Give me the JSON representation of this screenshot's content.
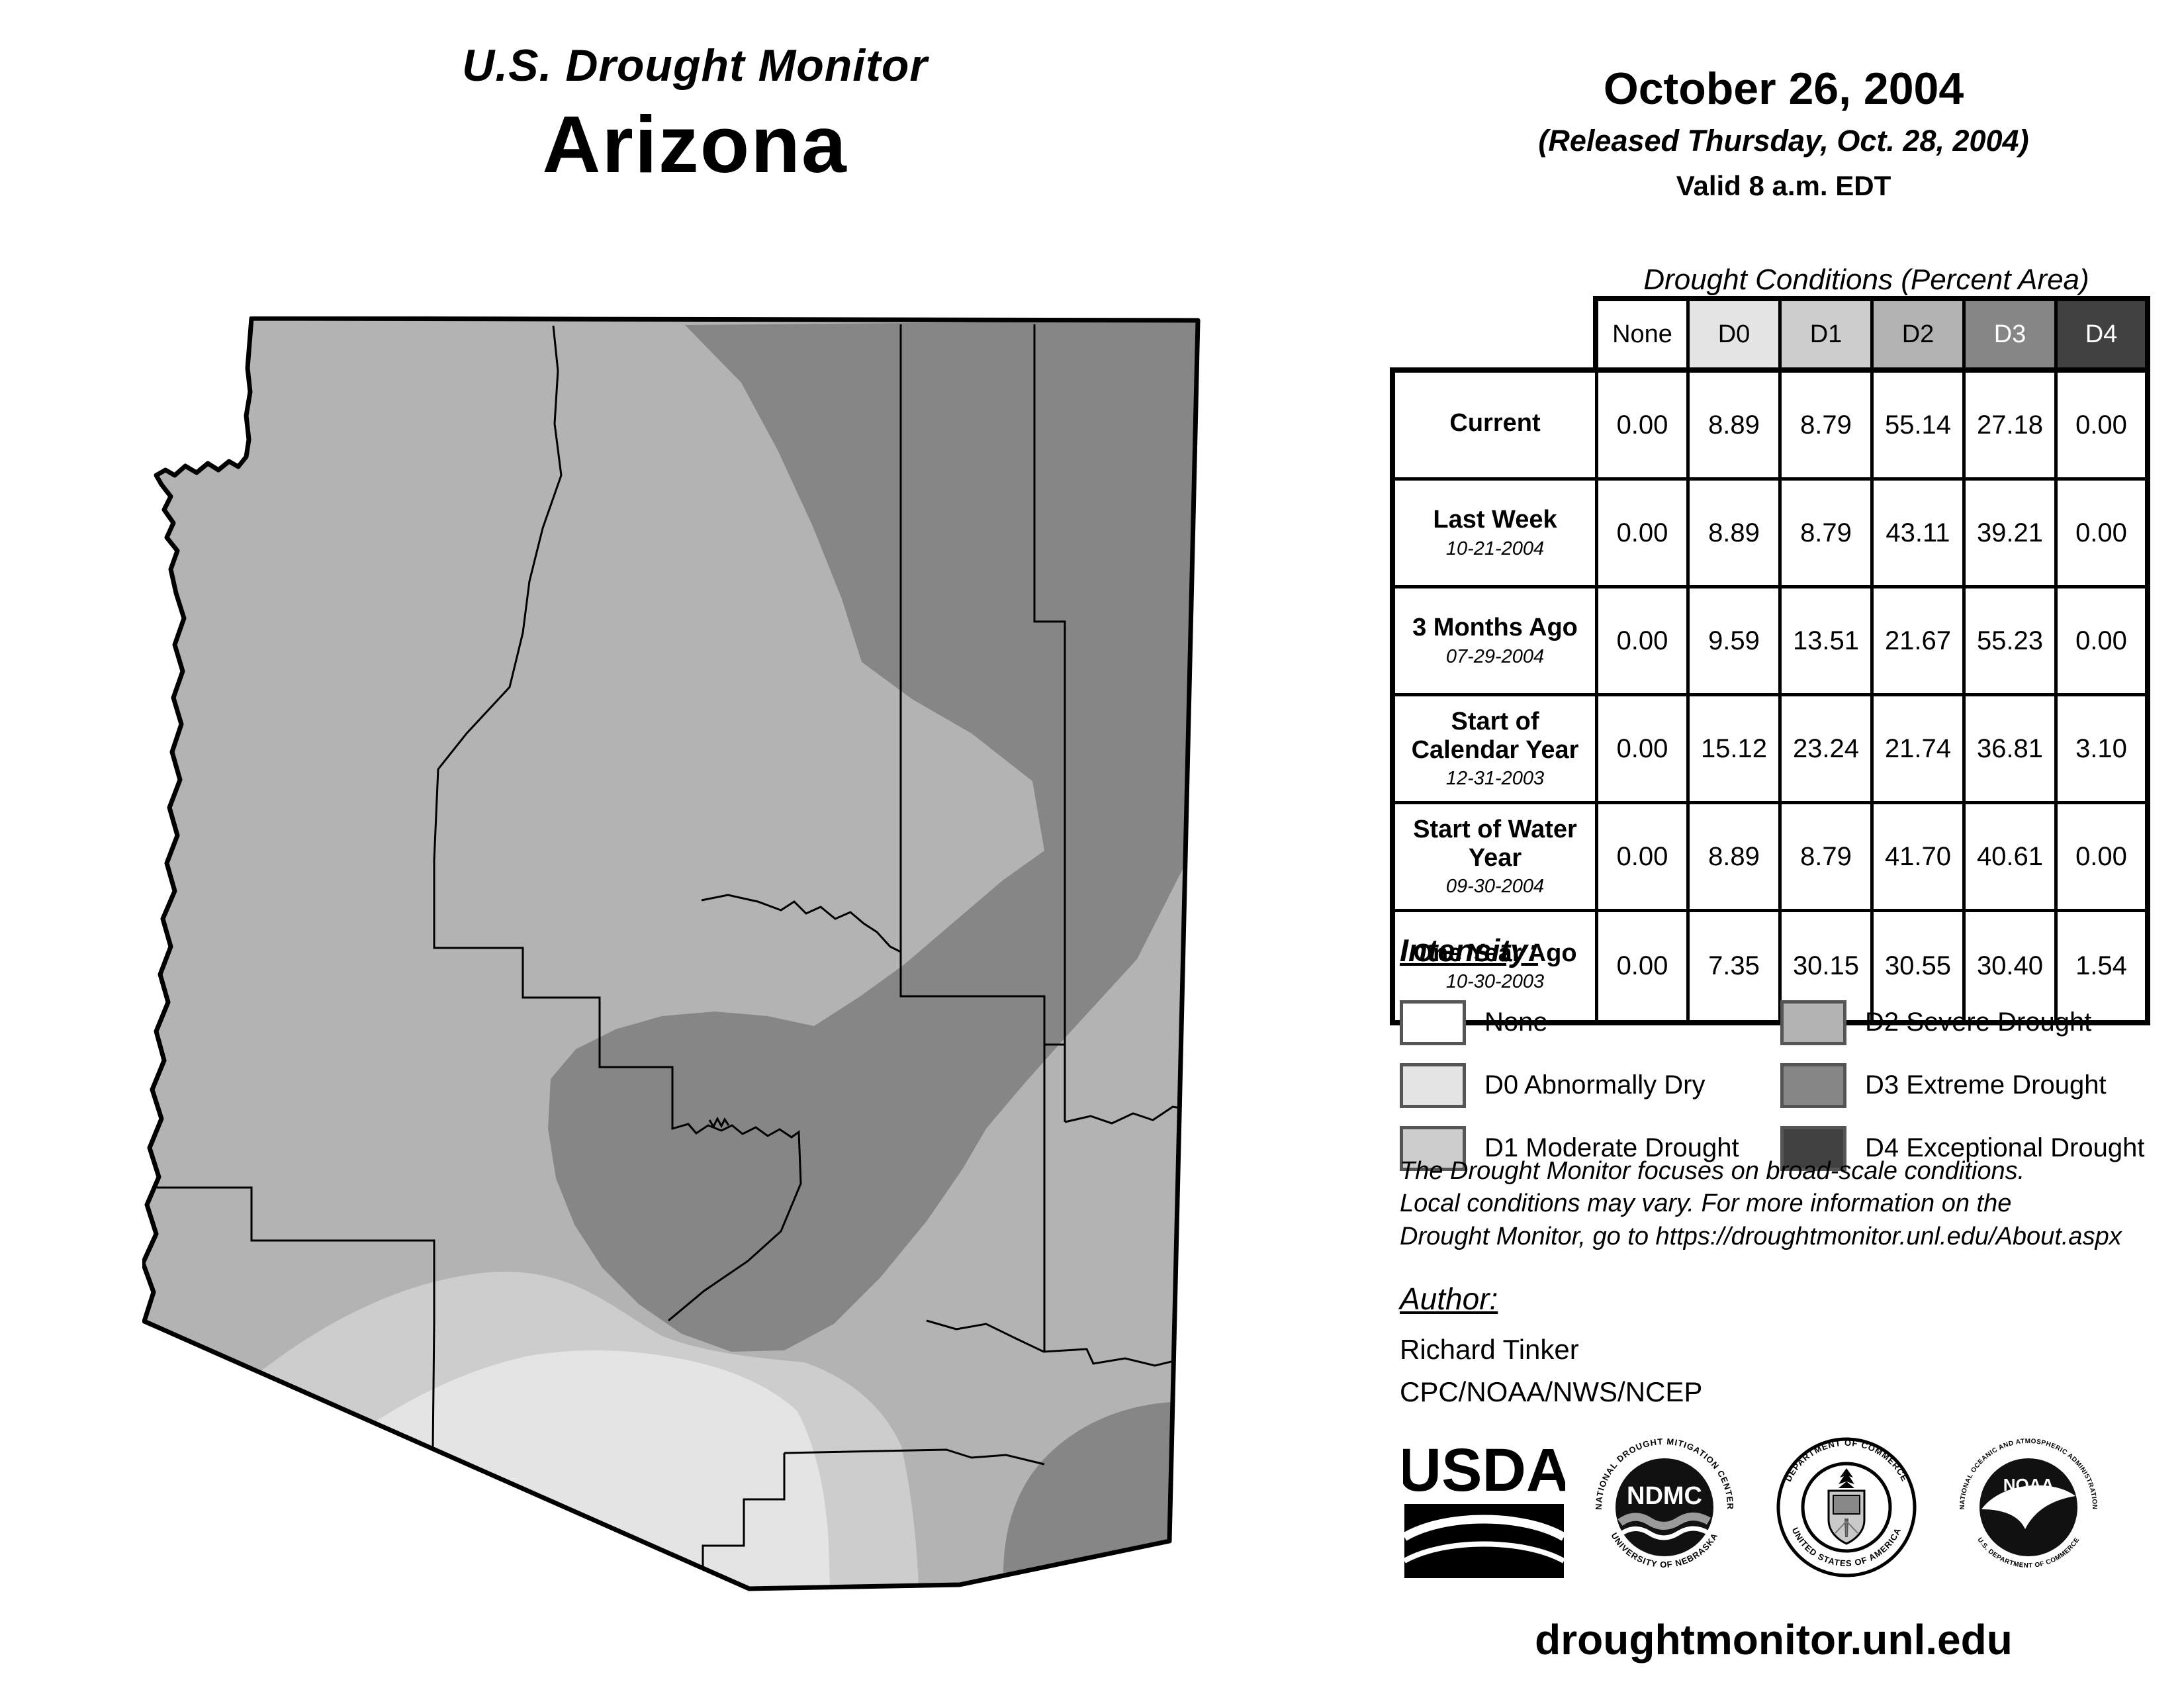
{
  "header": {
    "title": "U.S. Drought Monitor",
    "state": "Arizona",
    "date": "October 26, 2004",
    "released": "(Released Thursday, Oct. 28, 2004)",
    "valid": "Valid 8 a.m. EDT"
  },
  "table": {
    "title": "Drought Conditions (Percent Area)",
    "columns": [
      "None",
      "D0",
      "D1",
      "D2",
      "D3",
      "D4"
    ],
    "rows": [
      {
        "label": "Current",
        "date": "",
        "values": [
          "0.00",
          "8.89",
          "8.79",
          "55.14",
          "27.18",
          "0.00"
        ]
      },
      {
        "label": "Last Week",
        "date": "10-21-2004",
        "values": [
          "0.00",
          "8.89",
          "8.79",
          "43.11",
          "39.21",
          "0.00"
        ]
      },
      {
        "label": "3 Months Ago",
        "date": "07-29-2004",
        "values": [
          "0.00",
          "9.59",
          "13.51",
          "21.67",
          "55.23",
          "0.00"
        ]
      },
      {
        "label": "Start of Calendar Year",
        "date": "12-31-2003",
        "values": [
          "0.00",
          "15.12",
          "23.24",
          "21.74",
          "36.81",
          "3.10"
        ]
      },
      {
        "label": "Start of Water Year",
        "date": "09-30-2004",
        "values": [
          "0.00",
          "8.89",
          "8.79",
          "41.70",
          "40.61",
          "0.00"
        ]
      },
      {
        "label": "One Year Ago",
        "date": "10-30-2003",
        "values": [
          "0.00",
          "7.35",
          "30.15",
          "30.55",
          "30.40",
          "1.54"
        ]
      }
    ]
  },
  "legend": {
    "heading": "Intensity:",
    "items": [
      {
        "label": "None",
        "color": "#ffffff"
      },
      {
        "label": "D0 Abnormally Dry",
        "color": "#e4e4e4"
      },
      {
        "label": "D1 Moderate Drought",
        "color": "#cdcdcd"
      },
      {
        "label": "D2 Severe Drought",
        "color": "#b3b3b3"
      },
      {
        "label": "D3 Extreme Drought",
        "color": "#868686"
      },
      {
        "label": "D4 Exceptional Drought",
        "color": "#414141"
      }
    ]
  },
  "disclaimer": {
    "line1": "The Drought Monitor focuses on broad-scale conditions.",
    "line2": "Local conditions may vary. For more information on the",
    "line3": "Drought Monitor, go to https://droughtmonitor.unl.edu/About.aspx"
  },
  "author": {
    "heading": "Author:",
    "name": "Richard Tinker",
    "org": "CPC/NOAA/NWS/NCEP"
  },
  "logos": {
    "usda": "USDA",
    "ndmc": "NDMC",
    "ndmc_ring_top": "NATIONAL DROUGHT MITIGATION CENTER",
    "ndmc_ring_bottom": "UNIVERSITY OF NEBRASKA",
    "doc_ring_top": "DEPARTMENT OF COMMERCE",
    "doc_ring_bottom": "UNITED STATES OF AMERICA",
    "noaa": "NOAA",
    "noaa_ring_top": "NATIONAL OCEANIC AND ATMOSPHERIC ADMINISTRATION",
    "noaa_ring_bottom": "U.S. DEPARTMENT OF COMMERCE"
  },
  "footer": {
    "url": "droughtmonitor.unl.edu"
  },
  "map": {
    "region": "Arizona with county boundaries",
    "colors": {
      "none": "#ffffff",
      "d0": "#e4e4e4",
      "d1": "#cdcdcd",
      "d2": "#b3b3b3",
      "d3": "#868686",
      "d4": "#414141",
      "outline": "#000000"
    }
  }
}
